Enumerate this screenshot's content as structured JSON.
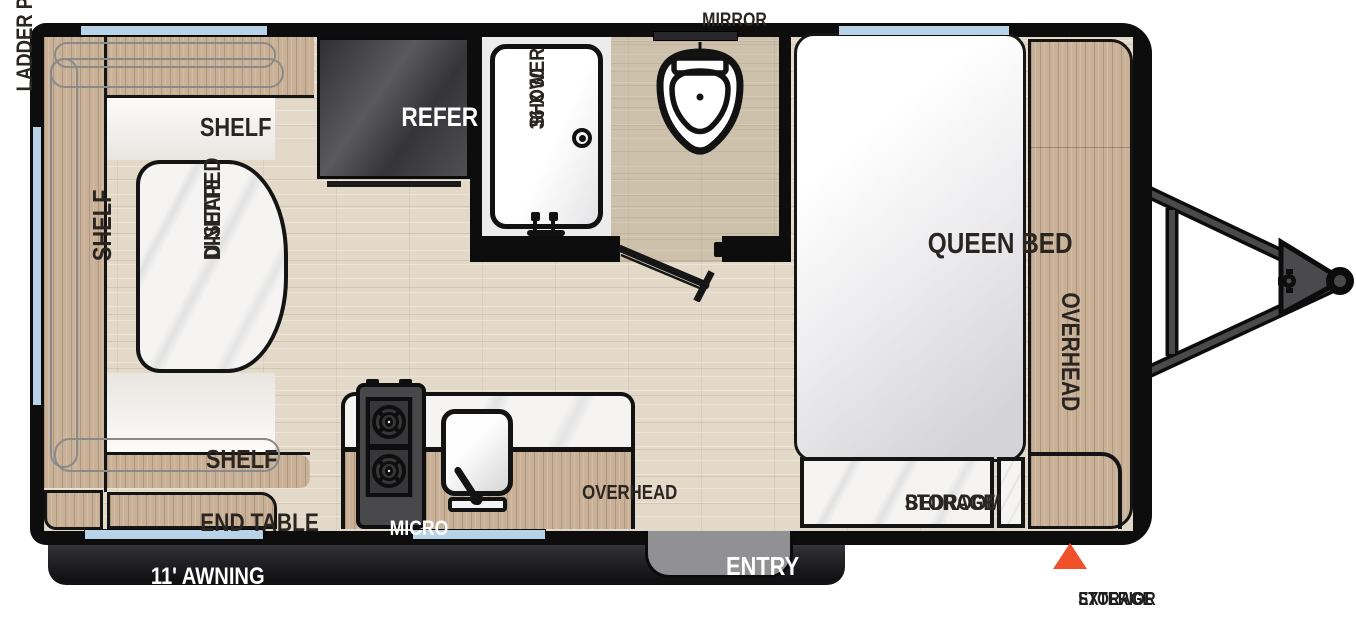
{
  "title": "Travel trailer floor plan",
  "labels": {
    "ladder_prep": "LADDER PREP",
    "mirror": "MIRROR",
    "refer": "REFER",
    "shower": [
      "36 X 30",
      "SHOWER"
    ],
    "shelf_top": "SHELF",
    "shelf_left": "SHELF",
    "shelf_bottom": "SHELF",
    "dinette": [
      "U-SHAPED",
      "DINETTE"
    ],
    "end_table": "END TABLE",
    "awning": "11' AWNING",
    "micro": "MICRO",
    "overhead_kitchen": "OVERHEAD",
    "entry": "ENTRY",
    "queen_bed": "QUEEN BED",
    "overhead_bedroom": "OVERHEAD",
    "bedroom_storage": [
      "BEDROOM",
      "STORAGE"
    ],
    "exterior_storage": [
      "EXTERIOR",
      "STORAGE"
    ]
  },
  "colors": {
    "wall": "#0d0d0d",
    "floor": "#e3d9c8",
    "wood": "#c9b197",
    "marble": "#f5f4f2",
    "window": "#b8d3e8",
    "accent_orange": "#f0512a",
    "entry_gray": "#919193",
    "steel": "#4a4a4d",
    "outline_gray": "#8a8a8a",
    "text_dark": "#2a2520"
  }
}
